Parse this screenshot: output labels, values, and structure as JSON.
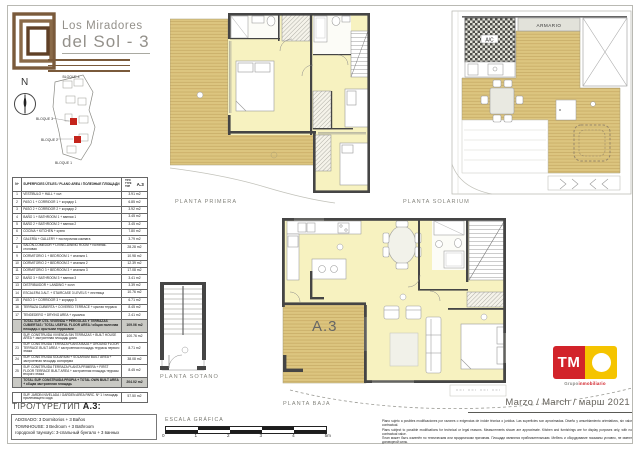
{
  "header": {
    "title_line1": "Los Miradores",
    "title_line2": "del Sol - 3"
  },
  "compass": {
    "north_label": "N"
  },
  "site_plan": {
    "bloque_4": "BLOQUE 4",
    "bloque_3": "BLOQUE 3",
    "bloque_2": "BLOQUE 2",
    "bloque_1": "BLOQUE 1",
    "highlight_color": "#c4241c"
  },
  "areas_table": {
    "col_num": "Nº",
    "col_desc": "SUPERFICIES ÚTILES / PLANO AREA / ПОЛЕЗНЫЕ ПЛОЩАДИ",
    "col_tipo": "TIPO TYPE ТИП",
    "tipo_value": "A.3",
    "rows": [
      {
        "num": "1",
        "desc": "VESTÍBULO + HALL + хол",
        "value": "3.91 m2"
      },
      {
        "num": "2",
        "desc": "PASO 1 + CORRIDOR 1 + коридор 1",
        "value": "6.85 m2"
      },
      {
        "num": "3",
        "desc": "PASO 2 + CORRIDOR 2 + коридор 2",
        "value": "3.92 m2"
      },
      {
        "num": "4",
        "desc": "BAÑO 1 + BATHROOM 1 + ванная 1",
        "value": "3.45 m2"
      },
      {
        "num": "5",
        "desc": "BAÑO 2 + BATHROOM 2 + ванная 2",
        "value": "3.45 m2"
      },
      {
        "num": "6",
        "desc": "COCINA + KITCHEN + кухня",
        "value": "7.80 m2"
      },
      {
        "num": "7",
        "desc": "GALERÍA + GALLERY + постирочная комната",
        "value": "3.79 m2"
      },
      {
        "num": "8",
        "desc": "SALÓN-COMEDOR + LIVING-DINING ROOM + гостиная-столовая",
        "value": "28.28 m2"
      },
      {
        "num": "9",
        "desc": "DORMITORIO 1 + BEDROOM 1 + спальня 1",
        "value": "10.98 m2"
      },
      {
        "num": "10",
        "desc": "DORMITORIO 2 + BEDROOM 2 + спальня 2",
        "value": "12.39 m2"
      },
      {
        "num": "11",
        "desc": "DORMITORIO 3 + BEDROOM 3 + спальня 3",
        "value": "17.08 m2"
      },
      {
        "num": "12",
        "desc": "BAÑO 3 + BATHROOM 3 + ванная 3",
        "value": "3.41 m2"
      },
      {
        "num": "13",
        "desc": "DISTRIBUIDOR + LANDING + холл",
        "value": "3.39 m2"
      },
      {
        "num": "14",
        "desc": "ESCALERA 3 ALT. + STAIRCASE 3 LEVELS + лестница",
        "value": "10.76 m2"
      },
      {
        "num": "15",
        "desc": "PASO 3 + CORRIDOR 3 + коридор 3",
        "value": "6.71 m2"
      },
      {
        "num": "16",
        "desc": "TERRAZA CUBIERTA + COVERED TERRACE + крытая терраса",
        "value": "8.45 m2"
      },
      {
        "num": "17",
        "desc": "TENDEDERO + DRYING AREA + сушилка",
        "value": "2.41 m2"
      },
      {
        "num": "",
        "desc": "TOTAL SUP. ÚTIL VIVIENDA + PÉRGOLAS Y TERRAZAS CUBIERTAS / TOTAL USEFUL FLOOR AREA / общая полезная площадь с крытыми террасами",
        "value": "109.06 m2",
        "cls": "gray"
      },
      {
        "num": "",
        "desc": "SUP. CONSTRUIDA VIVIENDA SIN TERRAZAS + BUILT HOUSE AREA + застроенная площадь дома",
        "value": "100.76 m2"
      },
      {
        "num": "23",
        "desc": "SUP. CONSTRUIDA TERRAZA PLANTA BAJA + GROUND FLOOR TERRACE BUILT AREA + застроенная площадь террасы первого этажа",
        "value": "8.71 m2"
      },
      {
        "num": "24",
        "desc": "SUP. CONSTRUIDA SOLARIUM + SOLARIUM BUILT AREA + застроенная площадь соляриума",
        "value": "38.08 m2"
      },
      {
        "num": "25",
        "desc": "SUP. CONSTRUIDA TERRAZA PLANTA PRIMERA + FIRST FLOOR TERRACE BUILT AREA + застроенная площадь террасы второго этажа",
        "value": "8.45 m2"
      },
      {
        "num": "",
        "desc": "TOTAL SUP. CONSTRUIDA PROPIA + TOTAL OWN BUILT AREA + общая застроенная площадь",
        "value": "204.02 m2",
        "cls": "gray"
      }
    ],
    "garden_row": {
      "desc": "SUP. JARDÍN NIVELADA / GARDEN AREA PARC. Nº 1 / площадь прилегающего сада",
      "value": "57.50 m2"
    }
  },
  "tipo_block": {
    "label": "TIPO/TYPE/ТИП",
    "value": "A.3:",
    "line_es": "ADOSADO: 3 Dormitorios + 3 Baños",
    "line_en": "TOWNHOUSE: 3 Bedroom + 3 Bathroom",
    "line_ru": "городской таунхаус: 3-спальный бунгало + 3 ванных"
  },
  "plans": {
    "primera_label": "PLANTA PRIMERA",
    "solarium_label": "PLANTA SOLARIUM",
    "sotano_label": "PLANTA SOTANO",
    "baja_label": "PLANTA BAJA",
    "unit_label": "A.3",
    "armario_label": "ARMARIO",
    "ac_label": "A/C",
    "deck_color": "#dcc57f",
    "room_color": "#f7f2c0",
    "wall_color": "#454545"
  },
  "scale_bar": {
    "label": "ESCALA GRÁFICA",
    "ticks": [
      "0",
      "1",
      "2",
      "3",
      "4",
      "5m"
    ]
  },
  "disclaimer": {
    "line_es": "Plano sujeto a posibles modificaciones por razones o exigencias de índole técnica o jurídica. Las superficies son aproximadas. Diseño y amueblamiento orientativos, sin valor contractual.",
    "line_en": "Plans subject to possible modifications for technical or legal reasons. Measurements shown are approximate. Kitchen and furnishings are for display purposes only, with no contractual value.",
    "line_ru": "План может быть изменён по техническим или юридическим причинам. Площади являются приблизительными. Мебель и оборудование показаны условно, не имеют договорной силы."
  },
  "date_label": "Marzo / March / марш 2021",
  "brand": {
    "monogram": "TM",
    "tagline_gray": "Grupo",
    "tagline_red": "inmobiliario",
    "red": "#d2232a",
    "yellow": "#f5c400",
    "logo_brown": "#7a5a3b"
  }
}
